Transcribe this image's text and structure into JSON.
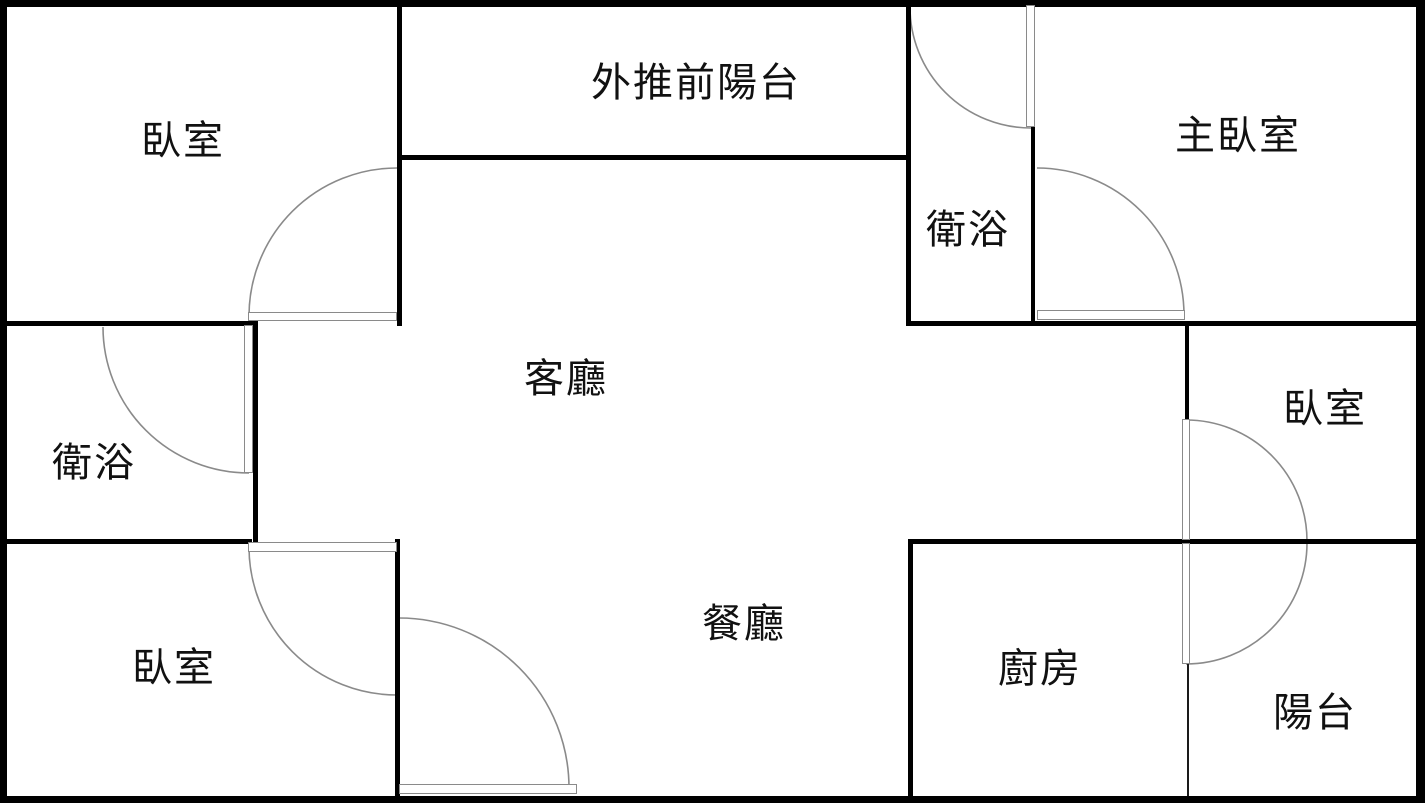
{
  "colors": {
    "wall": "#000000",
    "thin_wall": "#1a1a1a",
    "door": "#8a8a8a",
    "background": "#ffffff",
    "label": "#111111"
  },
  "rooms": [
    {
      "id": "bedroom-top-left",
      "label": "臥室",
      "x": 183,
      "y": 137
    },
    {
      "id": "front-balcony",
      "label": "外推前陽台",
      "x": 696,
      "y": 79
    },
    {
      "id": "master-bedroom",
      "label": "主臥室",
      "x": 1238,
      "y": 132
    },
    {
      "id": "bathroom-top-right",
      "label": "衛浴",
      "x": 968,
      "y": 226
    },
    {
      "id": "living-room",
      "label": "客廳",
      "x": 566,
      "y": 375
    },
    {
      "id": "bathroom-left",
      "label": "衛浴",
      "x": 94,
      "y": 459
    },
    {
      "id": "bedroom-right",
      "label": "臥室",
      "x": 1325,
      "y": 405
    },
    {
      "id": "bedroom-bottom-left",
      "label": "臥室",
      "x": 174,
      "y": 664
    },
    {
      "id": "dining-room",
      "label": "餐廳",
      "x": 744,
      "y": 620
    },
    {
      "id": "kitchen",
      "label": "廚房",
      "x": 1040,
      "y": 665
    },
    {
      "id": "rear-balcony",
      "label": "陽台",
      "x": 1315,
      "y": 709
    }
  ],
  "walls": {
    "outer": [
      {
        "id": "wall-outer-top",
        "x": 0,
        "y": 0,
        "w": 1425,
        "h": 7
      },
      {
        "id": "wall-outer-left",
        "x": 0,
        "y": 0,
        "w": 7,
        "h": 803
      },
      {
        "id": "wall-outer-bottom",
        "x": 0,
        "y": 796,
        "w": 1425,
        "h": 7
      },
      {
        "id": "wall-outer-right",
        "x": 1416,
        "y": 0,
        "w": 9,
        "h": 803
      }
    ],
    "inner": [
      {
        "id": "wall-bedroom-tl-right",
        "x": 397,
        "y": 5,
        "w": 5,
        "h": 321
      },
      {
        "id": "wall-balcony-bottom",
        "x": 399,
        "y": 155,
        "w": 509,
        "h": 5
      },
      {
        "id": "wall-bath-tr-left",
        "x": 906,
        "y": 5,
        "w": 5,
        "h": 321
      },
      {
        "id": "wall-bath-tr-right",
        "x": 1031,
        "y": 125,
        "w": 4,
        "h": 201
      },
      {
        "id": "wall-bedroom-tl-bottom",
        "x": 0,
        "y": 321,
        "w": 258,
        "h": 5
      },
      {
        "id": "wall-master-bottom",
        "x": 906,
        "y": 321,
        "w": 283,
        "h": 5
      },
      {
        "id": "wall-bedroom-r-top",
        "x": 1185,
        "y": 321,
        "w": 240,
        "h": 5
      },
      {
        "id": "wall-bedroom-r-left",
        "x": 1185,
        "y": 321,
        "w": 4,
        "h": 99
      },
      {
        "id": "wall-bath-l-right",
        "x": 253,
        "y": 321,
        "w": 5,
        "h": 223
      },
      {
        "id": "wall-bath-l-bottom",
        "x": 0,
        "y": 539,
        "w": 252,
        "h": 5
      },
      {
        "id": "wall-bedroom-bl-right",
        "x": 395,
        "y": 539,
        "w": 5,
        "h": 262
      },
      {
        "id": "wall-south-middle",
        "x": 908,
        "y": 539,
        "w": 517,
        "h": 5
      },
      {
        "id": "wall-kitchen-left",
        "x": 908,
        "y": 539,
        "w": 5,
        "h": 262
      }
    ],
    "thin": [
      {
        "id": "wall-kitchen-balcony-divider",
        "x": 1187,
        "y": 664,
        "w": 2,
        "h": 132
      }
    ]
  },
  "doors": {
    "leaves": [
      {
        "id": "door-leaf-bedroom-top-left",
        "x": 248,
        "y": 312,
        "w": 149,
        "h": 9
      },
      {
        "id": "door-leaf-bathroom-left",
        "x": 244,
        "y": 325,
        "w": 9,
        "h": 148
      },
      {
        "id": "door-leaf-bedroom-bottom-left",
        "x": 248,
        "y": 542,
        "w": 149,
        "h": 10
      },
      {
        "id": "door-leaf-entry",
        "x": 399,
        "y": 784,
        "w": 178,
        "h": 10
      },
      {
        "id": "door-leaf-bathroom-top-right",
        "x": 1026,
        "y": 5,
        "w": 9,
        "h": 122
      },
      {
        "id": "door-leaf-master-bedroom",
        "x": 1037,
        "y": 310,
        "w": 148,
        "h": 10
      },
      {
        "id": "door-leaf-bedroom-right",
        "x": 1182,
        "y": 419,
        "w": 8,
        "h": 121
      },
      {
        "id": "door-leaf-kitchen-balcony",
        "x": 1182,
        "y": 543,
        "w": 8,
        "h": 121
      }
    ],
    "arcs": [
      {
        "id": "door-arc-bedroom-top-left",
        "r": 148,
        "sx": 249,
        "sy": 316,
        "ex": 397,
        "ey": 168,
        "sweep": 1
      },
      {
        "id": "door-arc-bathroom-left",
        "r": 146,
        "sx": 103,
        "sy": 327,
        "ex": 249,
        "ey": 473,
        "sweep": 0
      },
      {
        "id": "door-arc-bathroom-top-right",
        "r": 121,
        "sx": 910,
        "sy": 7,
        "ex": 1031,
        "ey": 128,
        "sweep": 0
      },
      {
        "id": "door-arc-master-bedroom",
        "r": 147,
        "sx": 1037,
        "sy": 168,
        "ex": 1184,
        "ey": 315,
        "sweep": 1
      },
      {
        "id": "door-arc-bedroom-right",
        "r": 121,
        "sx": 1186,
        "sy": 420,
        "ex": 1307,
        "ey": 541,
        "sweep": 1
      },
      {
        "id": "door-arc-kitchen-balcony",
        "r": 121,
        "sx": 1186,
        "sy": 664,
        "ex": 1307,
        "ey": 543,
        "sweep": 0
      },
      {
        "id": "door-arc-bedroom-bottom-left",
        "r": 148,
        "sx": 249,
        "sy": 547,
        "ex": 397,
        "ey": 695,
        "sweep": 0
      },
      {
        "id": "door-arc-entry",
        "r": 170,
        "sx": 399,
        "sy": 618,
        "ex": 569,
        "ey": 788,
        "sweep": 1
      }
    ]
  }
}
